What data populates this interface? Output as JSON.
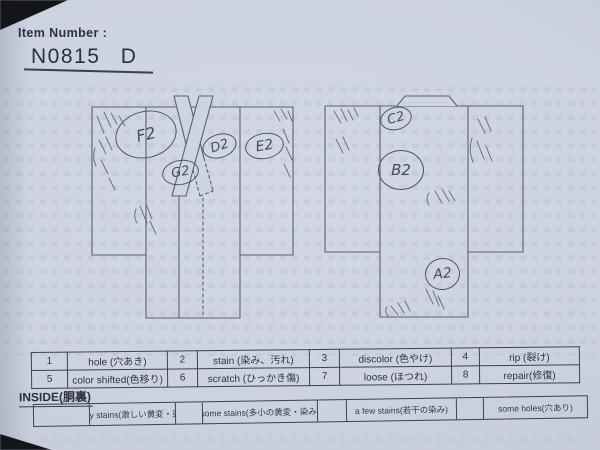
{
  "header": {
    "label": "Item Number :",
    "value": "N0815 D"
  },
  "marks": {
    "front": [
      {
        "label": "F2"
      },
      {
        "label": "G2"
      },
      {
        "label": "D2"
      },
      {
        "label": "E2"
      }
    ],
    "back": [
      {
        "label": "C2"
      },
      {
        "label": "B2"
      },
      {
        "label": "A2"
      }
    ]
  },
  "defect_table": {
    "rows": [
      {
        "cells": [
          {
            "num": "1",
            "label": "hole (穴あき)"
          },
          {
            "num": "2",
            "label": "stain (染み、汚れ)"
          },
          {
            "num": "3",
            "label": "discolor (色やけ)"
          },
          {
            "num": "4",
            "label": "rip (裂け)"
          }
        ]
      },
      {
        "cells": [
          {
            "num": "5",
            "label": "color shifted(色移り)"
          },
          {
            "num": "6",
            "label": "scratch (ひっかき傷)"
          },
          {
            "num": "7",
            "label": "loose (ほつれ)"
          },
          {
            "num": "8",
            "label": "repair(修復)"
          }
        ]
      }
    ]
  },
  "inside_section": {
    "title": "INSIDE(胴裏)",
    "cells": [
      {
        "stamp": ""
      },
      {
        "stamp": "many stains(激しい黄変・染み)"
      },
      {
        "stamp": ""
      },
      {
        "stamp": "some stains(多小の黄変・染み)"
      },
      {
        "stamp": ""
      },
      {
        "stamp": "a few stains(若干の染み)"
      },
      {
        "stamp": ""
      },
      {
        "stamp": "some holes(穴あり)"
      }
    ]
  },
  "colors": {
    "paper": "#cdd2e1",
    "ink": "#2d3140",
    "pencil": "#5b6070",
    "photo_background": "#15161a"
  }
}
